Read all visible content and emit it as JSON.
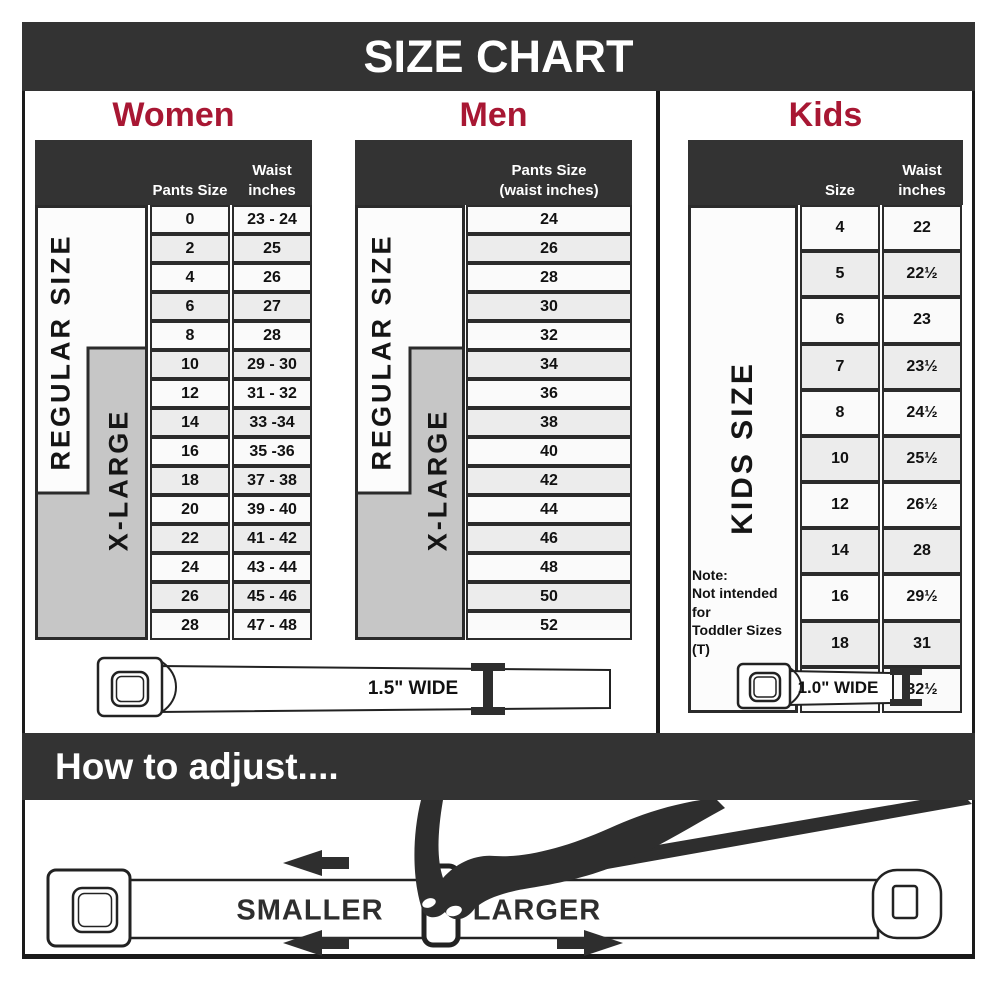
{
  "title": "SIZE CHART",
  "sections": {
    "women": {
      "heading": "Women",
      "regular_label": "REGULAR SIZE",
      "xlarge_label": "X-LARGE",
      "col_pants": "Pants Size",
      "col_waist": "Waist\ninches",
      "rows": [
        [
          "0",
          "23 - 24"
        ],
        [
          "2",
          "25"
        ],
        [
          "4",
          "26"
        ],
        [
          "6",
          "27"
        ],
        [
          "8",
          "28"
        ],
        [
          "10",
          "29 - 30"
        ],
        [
          "12",
          "31 - 32"
        ],
        [
          "14",
          "33 -34"
        ],
        [
          "16",
          "35 -36"
        ],
        [
          "18",
          "37 - 38"
        ],
        [
          "20",
          "39 - 40"
        ],
        [
          "22",
          "41 - 42"
        ],
        [
          "24",
          "43 - 44"
        ],
        [
          "26",
          "45 - 46"
        ],
        [
          "28",
          "47 - 48"
        ]
      ],
      "belt_label": "1.5\" WIDE"
    },
    "men": {
      "heading": "Men",
      "regular_label": "REGULAR SIZE",
      "xlarge_label": "X-LARGE",
      "col_pants": "Pants Size\n(waist inches)",
      "rows": [
        "24",
        "26",
        "28",
        "30",
        "32",
        "34",
        "36",
        "38",
        "40",
        "42",
        "44",
        "46",
        "48",
        "50",
        "52"
      ]
    },
    "kids": {
      "heading": "Kids",
      "band_label": "KIDS SIZE",
      "col_size": "Size",
      "col_waist": "Waist\ninches",
      "rows": [
        [
          "4",
          "22"
        ],
        [
          "5",
          "22½"
        ],
        [
          "6",
          "23"
        ],
        [
          "7",
          "23½"
        ],
        [
          "8",
          "24½"
        ],
        [
          "10",
          "25½"
        ],
        [
          "12",
          "26½"
        ],
        [
          "14",
          "28"
        ],
        [
          "16",
          "29½"
        ],
        [
          "18",
          "31"
        ],
        [
          "20",
          "32½"
        ]
      ],
      "note": "Note:\nNot intended for\nToddler Sizes (T)",
      "belt_label": "1.0\" WIDE"
    }
  },
  "how_to_adjust": {
    "heading": "How to adjust....",
    "smaller": "SMALLER",
    "larger": "LARGER"
  },
  "colors": {
    "banner": "#333333",
    "accent_red": "#a81733",
    "band_gray": "#c6c6c6",
    "row_alt": "#ececec",
    "border_dark": "#2b2b2b"
  }
}
